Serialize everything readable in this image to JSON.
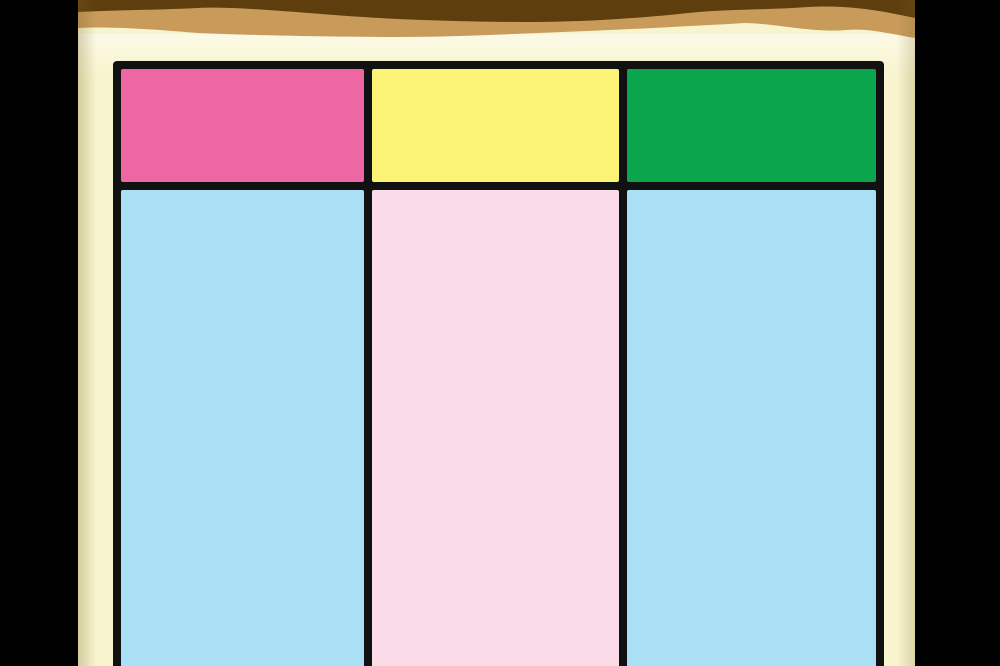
{
  "scene": {
    "kind": "cartoon-still-blank-chart",
    "letterbox_color": "#000000",
    "page_color": "#f8f4cd",
    "banner_dark_color": "#5e3e0d",
    "banner_tan_color": "#c89b5b",
    "grid_line_color": "#111111",
    "table": {
      "column_count": 3,
      "header_row_present": true,
      "columns": [
        {
          "header_color": "#ee67a2",
          "body_color": "#a9e0f5"
        },
        {
          "header_color": "#fbf376",
          "body_color": "#fadce8"
        },
        {
          "header_color": "#0ba54d",
          "body_color": "#a9e0f5"
        }
      ]
    }
  }
}
